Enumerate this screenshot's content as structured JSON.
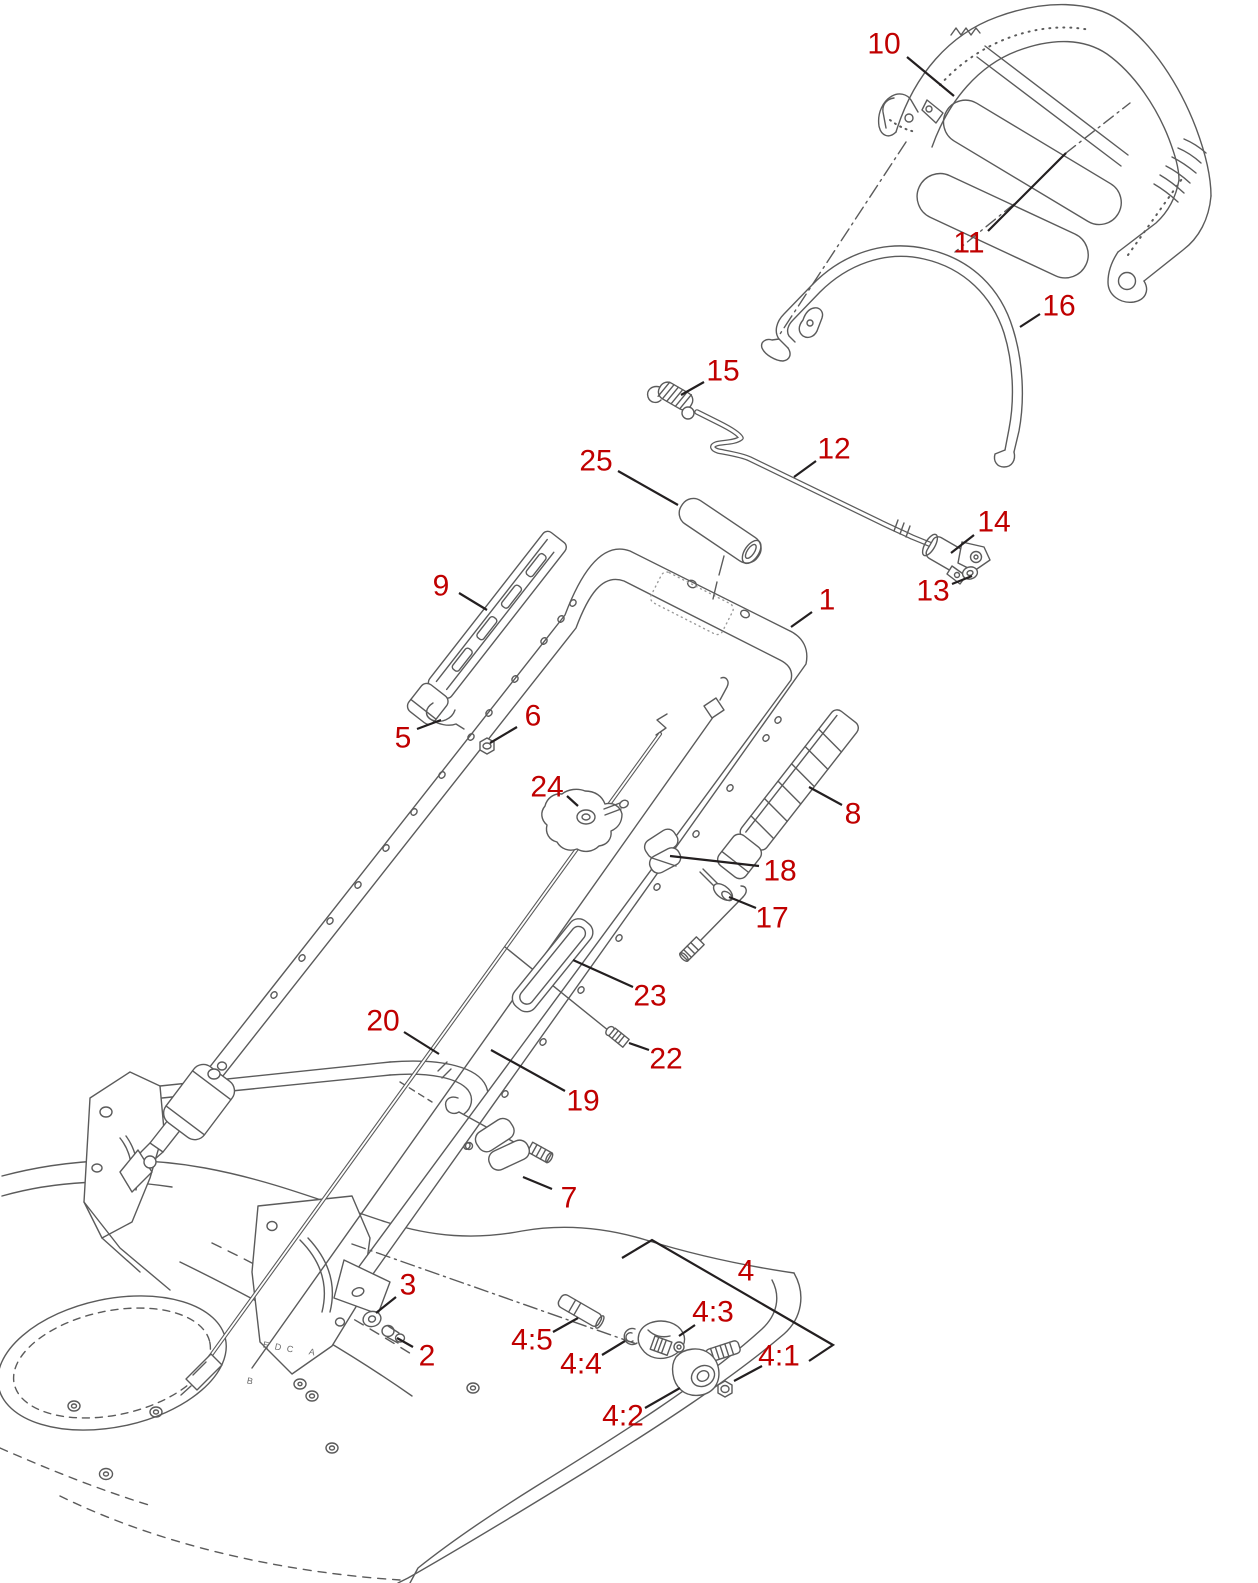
{
  "diagram": {
    "type": "exploded-parts-diagram",
    "subject": "lawn mower handle assembly",
    "colors": {
      "background": "#ffffff",
      "art_line": "#5b5b5b",
      "leader_line": "#231f20",
      "callout_text": "#c00000"
    },
    "callouts": [
      {
        "id": "10",
        "label": "10",
        "x": 884,
        "y": 44,
        "leader": [
          [
            907,
            57
          ],
          [
            954,
            96
          ]
        ]
      },
      {
        "id": "11",
        "label": "11",
        "x": 969,
        "y": 243,
        "leader": [
          [
            988,
            231
          ],
          [
            1066,
            153
          ]
        ]
      },
      {
        "id": "16",
        "label": "16",
        "x": 1059,
        "y": 306,
        "leader": [
          [
            1040,
            314
          ],
          [
            1020,
            327
          ]
        ]
      },
      {
        "id": "15",
        "label": "15",
        "x": 723,
        "y": 371,
        "leader": [
          [
            704,
            382
          ],
          [
            681,
            395
          ]
        ]
      },
      {
        "id": "12",
        "label": "12",
        "x": 834,
        "y": 449,
        "leader": [
          [
            816,
            461
          ],
          [
            794,
            477
          ]
        ]
      },
      {
        "id": "25",
        "label": "25",
        "x": 596,
        "y": 461,
        "leader": [
          [
            618,
            471
          ],
          [
            678,
            505
          ]
        ]
      },
      {
        "id": "14",
        "label": "14",
        "x": 994,
        "y": 522,
        "leader": [
          [
            974,
            535
          ],
          [
            951,
            553
          ]
        ]
      },
      {
        "id": "13",
        "label": "13",
        "x": 933,
        "y": 591,
        "leader": [
          [
            952,
            584
          ],
          [
            972,
            576
          ]
        ]
      },
      {
        "id": "1",
        "label": "1",
        "x": 827,
        "y": 600,
        "leader": [
          [
            812,
            612
          ],
          [
            791,
            627
          ]
        ]
      },
      {
        "id": "9",
        "label": "9",
        "x": 441,
        "y": 586,
        "leader": [
          [
            459,
            593
          ],
          [
            487,
            610
          ]
        ]
      },
      {
        "id": "5",
        "label": "5",
        "x": 403,
        "y": 738,
        "leader": [
          [
            417,
            729
          ],
          [
            441,
            720
          ]
        ]
      },
      {
        "id": "6",
        "label": "6",
        "x": 533,
        "y": 716,
        "leader": [
          [
            517,
            727
          ],
          [
            490,
            743
          ]
        ]
      },
      {
        "id": "24",
        "label": "24",
        "x": 547,
        "y": 787,
        "leader": [
          [
            567,
            796
          ],
          [
            578,
            806
          ]
        ]
      },
      {
        "id": "8",
        "label": "8",
        "x": 853,
        "y": 814,
        "leader": [
          [
            842,
            805
          ],
          [
            809,
            787
          ]
        ]
      },
      {
        "id": "18",
        "label": "18",
        "x": 780,
        "y": 871,
        "leader": [
          [
            759,
            866
          ],
          [
            670,
            856
          ]
        ]
      },
      {
        "id": "17",
        "label": "17",
        "x": 772,
        "y": 918,
        "leader": [
          [
            756,
            908
          ],
          [
            729,
            897
          ]
        ]
      },
      {
        "id": "23",
        "label": "23",
        "x": 650,
        "y": 996,
        "leader": [
          [
            633,
            987
          ],
          [
            573,
            960
          ]
        ]
      },
      {
        "id": "20",
        "label": "20",
        "x": 383,
        "y": 1021,
        "leader": [
          [
            404,
            1032
          ],
          [
            439,
            1054
          ]
        ]
      },
      {
        "id": "22",
        "label": "22",
        "x": 666,
        "y": 1059,
        "leader": [
          [
            649,
            1050
          ],
          [
            629,
            1043
          ]
        ]
      },
      {
        "id": "19",
        "label": "19",
        "x": 583,
        "y": 1101,
        "leader": [
          [
            565,
            1091
          ],
          [
            491,
            1050
          ]
        ]
      },
      {
        "id": "7",
        "label": "7",
        "x": 569,
        "y": 1198,
        "leader": [
          [
            552,
            1189
          ],
          [
            523,
            1177
          ]
        ]
      },
      {
        "id": "3",
        "label": "3",
        "x": 408,
        "y": 1285,
        "leader": [
          [
            396,
            1297
          ],
          [
            376,
            1313
          ]
        ]
      },
      {
        "id": "2",
        "label": "2",
        "x": 427,
        "y": 1356,
        "leader": [
          [
            413,
            1347
          ],
          [
            397,
            1338
          ]
        ]
      },
      {
        "id": "4",
        "label": "4",
        "x": 746,
        "y": 1271,
        "leader": []
      },
      {
        "id": "4:5",
        "label": "4:5",
        "x": 532,
        "y": 1340,
        "leader": [
          [
            553,
            1332
          ],
          [
            578,
            1318
          ]
        ]
      },
      {
        "id": "4:4",
        "label": "4:4",
        "x": 581,
        "y": 1364,
        "leader": [
          [
            602,
            1355
          ],
          [
            625,
            1341
          ]
        ]
      },
      {
        "id": "4:3",
        "label": "4:3",
        "x": 713,
        "y": 1312,
        "leader": [
          [
            695,
            1325
          ],
          [
            679,
            1336
          ]
        ]
      },
      {
        "id": "4:2",
        "label": "4:2",
        "x": 623,
        "y": 1416,
        "leader": [
          [
            645,
            1408
          ],
          [
            680,
            1388
          ]
        ]
      },
      {
        "id": "4:1",
        "label": "4:1",
        "x": 779,
        "y": 1356,
        "leader": [
          [
            762,
            1366
          ],
          [
            734,
            1381
          ]
        ]
      }
    ],
    "group_brackets": [
      {
        "for": "4",
        "points": [
          [
            622,
            1258
          ],
          [
            652,
            1240
          ],
          [
            833,
            1345
          ],
          [
            809,
            1361
          ]
        ]
      }
    ],
    "deck_markings": [
      {
        "label": "E",
        "x": 266,
        "y": 1345
      },
      {
        "label": "D",
        "x": 278,
        "y": 1347
      },
      {
        "label": "C",
        "x": 290,
        "y": 1349
      },
      {
        "label": "A",
        "x": 312,
        "y": 1352
      },
      {
        "label": "B",
        "x": 250,
        "y": 1381
      }
    ]
  }
}
